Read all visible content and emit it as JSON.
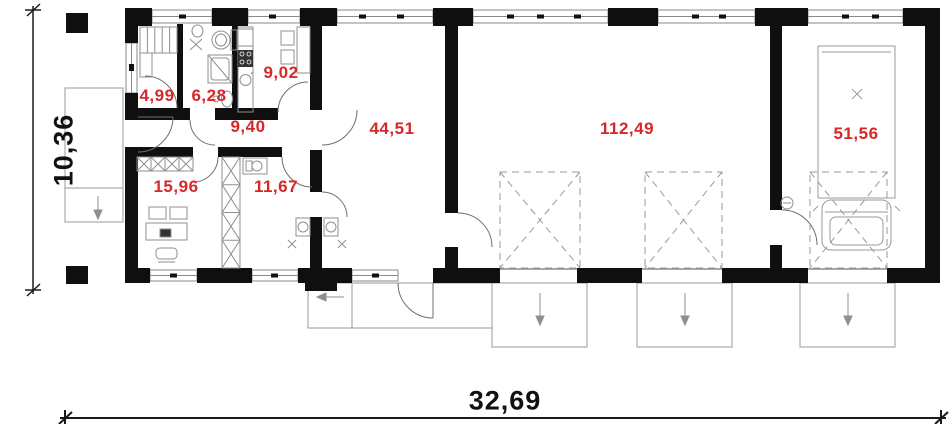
{
  "plan": {
    "title": "single-storey house floor plan with double garage",
    "rooms": [
      {
        "id": "wardrobe",
        "area": "4,99"
      },
      {
        "id": "bathroom",
        "area": "6,28"
      },
      {
        "id": "kitchen",
        "area": "9,02"
      },
      {
        "id": "hall",
        "area": "9,40"
      },
      {
        "id": "office",
        "area": "15,96"
      },
      {
        "id": "utility",
        "area": "11,67"
      },
      {
        "id": "living-room",
        "area": "44,51"
      },
      {
        "id": "main-garage",
        "area": "112,49"
      },
      {
        "id": "side-garage",
        "area": "51,56"
      }
    ],
    "dimensions": {
      "overall_width": "32,69",
      "overall_depth": "10,36"
    },
    "colors": {
      "area_label": "#d62828",
      "dimension_label": "#111111",
      "wall": "#0f0f0f",
      "furniture_line": "#8f8f8f",
      "site_line": "#9a9a9a"
    }
  }
}
